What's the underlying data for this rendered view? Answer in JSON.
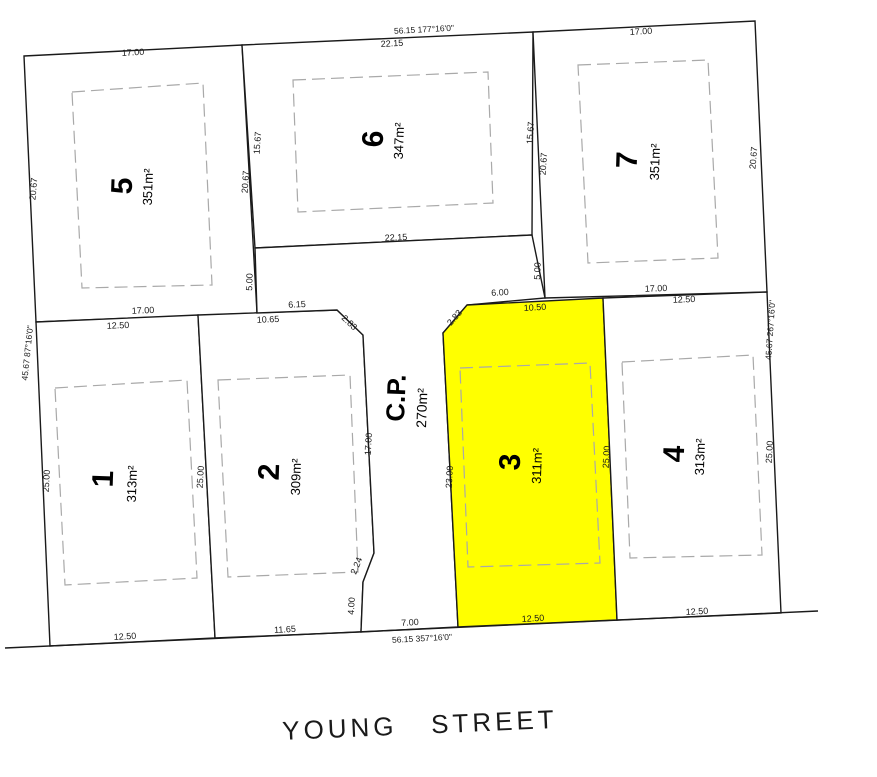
{
  "canvas": {
    "width": 877,
    "height": 777,
    "bg": "#ffffff"
  },
  "style": {
    "boundary_color": "#1a1a1a",
    "boundary_width": 1.4,
    "lot_fill": "#ffffff",
    "highlight_fill": "#ffff00",
    "envelope_color": "#a9a9a9",
    "envelope_width": 1.2,
    "envelope_dash": "13 6",
    "dim_color": "#1a1a1a",
    "dim_font_size": 9,
    "number_color": "#000000",
    "street_font_size": 26,
    "street_letter_spacing": 4
  },
  "street": {
    "name": "YOUNG STREET",
    "x": 420,
    "y": 727,
    "rotate": -2.5
  },
  "street_line": {
    "x1": 5,
    "y1": 648,
    "x2": 818,
    "y2": 611
  },
  "parcels": [
    {
      "id": "lot-5",
      "number": "5",
      "area": "351m²",
      "highlighted": false,
      "points": "24,56 242,45 257,313 36,322",
      "number_label": {
        "x": 124,
        "y": 186,
        "rotate": -88,
        "size": 30
      },
      "area_label": {
        "x": 149,
        "y": 187,
        "rotate": -88,
        "size": 13
      },
      "envelope": "72,92 203,83 212,285 82,288"
    },
    {
      "id": "lot-6",
      "number": "6",
      "area": "347m²",
      "highlighted": false,
      "points": "242,45 533,32 532,235 255,248",
      "number_label": {
        "x": 375,
        "y": 139,
        "rotate": -88,
        "size": 30
      },
      "area_label": {
        "x": 400,
        "y": 141,
        "rotate": -88,
        "size": 13
      },
      "envelope": "293,80 488,72 493,203 298,212"
    },
    {
      "id": "lot-7",
      "number": "7",
      "area": "351m²",
      "highlighted": false,
      "points": "533,32 755,21 767,292 545,298",
      "number_label": {
        "x": 629,
        "y": 160,
        "rotate": -88,
        "size": 30
      },
      "area_label": {
        "x": 656,
        "y": 162,
        "rotate": -88,
        "size": 13
      },
      "envelope": "578,65 708,60 718,258 588,263"
    },
    {
      "id": "lot-1",
      "number": "1",
      "area": "313m²",
      "highlighted": false,
      "points": "36,322 198,315 215,638 50,646",
      "number_label": {
        "x": 105,
        "y": 479,
        "rotate": -88,
        "size": 30
      },
      "area_label": {
        "x": 133,
        "y": 484,
        "rotate": -88,
        "size": 13
      },
      "envelope": "55,388 187,380 197,578 65,585"
    },
    {
      "id": "lot-2",
      "number": "2",
      "area": "309m²",
      "highlighted": false,
      "points": "198,315 337,310 363,335 374,553 363,582 361,632 215,638",
      "number_label": {
        "x": 271,
        "y": 472,
        "rotate": -88,
        "size": 30
      },
      "area_label": {
        "x": 297,
        "y": 477,
        "rotate": -88,
        "size": 13
      },
      "envelope": "218,380 350,375 358,572 228,577"
    },
    {
      "id": "common-property",
      "number": "C.P.",
      "area": "270m²",
      "highlighted": false,
      "points": "255,248 532,235 545,298 467,305 443,333 458,627 361,632 363,582 374,553 363,335 337,310 257,313",
      "number_label": {
        "x": 398,
        "y": 398,
        "rotate": -88,
        "size": 26
      },
      "area_label": {
        "x": 423,
        "y": 408,
        "rotate": -88,
        "size": 14
      },
      "envelope": null
    },
    {
      "id": "lot-3",
      "number": "3",
      "area": "311m²",
      "highlighted": true,
      "points": "467,305 603,298 617,620 458,627 443,333",
      "number_label": {
        "x": 512,
        "y": 462,
        "rotate": -88,
        "size": 30
      },
      "area_label": {
        "x": 538,
        "y": 466,
        "rotate": -88,
        "size": 13
      },
      "envelope": "460,368 590,363 600,563 468,567"
    },
    {
      "id": "lot-4",
      "number": "4",
      "area": "313m²",
      "highlighted": false,
      "points": "603,298 767,292 781,613 617,620",
      "number_label": {
        "x": 676,
        "y": 454,
        "rotate": -88,
        "size": 30
      },
      "area_label": {
        "x": 701,
        "y": 457,
        "rotate": -88,
        "size": 13
      },
      "envelope": "622,362 753,355 762,555 630,558"
    }
  ],
  "dimensions": [
    {
      "t": "17.00",
      "x": 133,
      "y": 53,
      "r": -3
    },
    {
      "t": "56.15  177°16'0\"",
      "x": 424,
      "y": 30,
      "r": -3,
      "s": 8.5
    },
    {
      "t": "22.15",
      "x": 392,
      "y": 44,
      "r": -3
    },
    {
      "t": "17.00",
      "x": 641,
      "y": 32,
      "r": -3
    },
    {
      "t": "22.15",
      "x": 396,
      "y": 238,
      "r": -2.5
    },
    {
      "t": "5.00",
      "x": 250,
      "y": 282,
      "r": -88
    },
    {
      "t": "5.00",
      "x": 538,
      "y": 271,
      "r": -88
    },
    {
      "t": "17.00",
      "x": 143,
      "y": 311,
      "r": -2.5
    },
    {
      "t": "12.50",
      "x": 118,
      "y": 326,
      "r": -2.5
    },
    {
      "t": "10.65",
      "x": 268,
      "y": 320,
      "r": -2.5
    },
    {
      "t": "6.15",
      "x": 297,
      "y": 305,
      "r": -2.5
    },
    {
      "t": "2.83",
      "x": 349,
      "y": 323,
      "r": 44
    },
    {
      "t": "6.00",
      "x": 500,
      "y": 293,
      "r": -3
    },
    {
      "t": "10.50",
      "x": 535,
      "y": 308,
      "r": -3
    },
    {
      "t": "2.83",
      "x": 455,
      "y": 318,
      "r": -49
    },
    {
      "t": "17.00",
      "x": 656,
      "y": 289,
      "r": -2
    },
    {
      "t": "12.50",
      "x": 684,
      "y": 300,
      "r": -2
    },
    {
      "t": "20.67",
      "x": 34,
      "y": 189,
      "r": -85
    },
    {
      "t": "20.67",
      "x": 246,
      "y": 182,
      "r": -86
    },
    {
      "t": "15.67",
      "x": 258,
      "y": 143,
      "r": -86
    },
    {
      "t": "15.67",
      "x": 531,
      "y": 133,
      "r": -86
    },
    {
      "t": "20.67",
      "x": 544,
      "y": 164,
      "r": -86
    },
    {
      "t": "20.67",
      "x": 754,
      "y": 158,
      "r": -85
    },
    {
      "t": "45.67  87°16'0\"",
      "x": 28,
      "y": 353,
      "r": -84,
      "s": 8.5
    },
    {
      "t": "45.67  267°16'0\"",
      "x": 771,
      "y": 330,
      "r": -86,
      "s": 8.5
    },
    {
      "t": "17.00",
      "x": 369,
      "y": 444,
      "r": -87
    },
    {
      "t": "2.24",
      "x": 357,
      "y": 566,
      "r": -68
    },
    {
      "t": "4.00",
      "x": 352,
      "y": 606,
      "r": -87
    },
    {
      "t": "23.00",
      "x": 450,
      "y": 477,
      "r": -87
    },
    {
      "t": "25.00",
      "x": 607,
      "y": 457,
      "r": -87
    },
    {
      "t": "25.00",
      "x": 47,
      "y": 481,
      "r": -87
    },
    {
      "t": "25.00",
      "x": 201,
      "y": 477,
      "r": -87
    },
    {
      "t": "25.00",
      "x": 770,
      "y": 452,
      "r": -87
    },
    {
      "t": "12.50",
      "x": 125,
      "y": 637,
      "r": -3
    },
    {
      "t": "11.65",
      "x": 285,
      "y": 630,
      "r": -3
    },
    {
      "t": "7.00",
      "x": 410,
      "y": 623,
      "r": -3
    },
    {
      "t": "56.15  357°16'0\"",
      "x": 422,
      "y": 639,
      "r": -3,
      "s": 8.5
    },
    {
      "t": "12.50",
      "x": 533,
      "y": 619,
      "r": -3
    },
    {
      "t": "12.50",
      "x": 697,
      "y": 612,
      "r": -3
    }
  ]
}
